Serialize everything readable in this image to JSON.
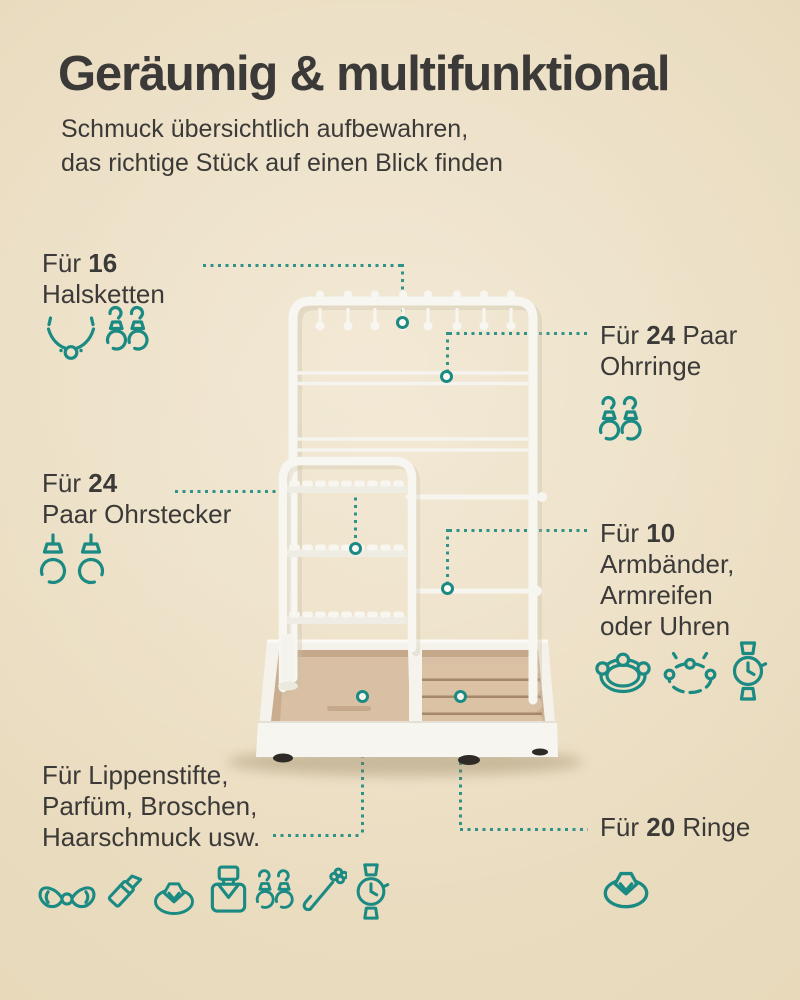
{
  "colors": {
    "accent": "#1a8a82",
    "text": "#3b3a38",
    "bg": "#e8dabc",
    "product_white": "#f8f6f1",
    "velvet": "#d9bfa3"
  },
  "header": {
    "title": "Geräumig & multifunktional",
    "subtitle1": "Schmuck übersichtlich aufbewahren,",
    "subtitle2": "das richtige Stück auf einen Blick finden"
  },
  "callouts": {
    "necklaces": {
      "pre": "Für ",
      "num": "16",
      "post": "",
      "line2": "Halsketten",
      "icons": [
        "necklace-icon",
        "earrings-pair-icon"
      ]
    },
    "earrings": {
      "pre": "Für ",
      "num": "24",
      "post": " Paar",
      "line2": "Ohrringe",
      "icons": [
        "earrings-pair-icon"
      ]
    },
    "studs": {
      "pre": "Für ",
      "num": "24",
      "post": "",
      "line2": "Paar Ohrstecker",
      "icons": [
        "stud-earrings-pair-icon"
      ]
    },
    "bracelets": {
      "pre": "Für ",
      "num": "10",
      "post": "",
      "line2": "Armbänder,",
      "line3": "Armreifen",
      "line4": "oder Uhren",
      "icons": [
        "bracelet-icon",
        "bangle-icon",
        "watch-icon"
      ]
    },
    "accessories": {
      "line1": "Für Lippenstifte,",
      "line2": "Parfüm, Broschen,",
      "line3": "Haarschmuck usw.",
      "icons": [
        "bow-icon",
        "lipstick-icon",
        "ring-icon",
        "perfume-icon",
        "earrings-pair-icon",
        "hairpin-icon",
        "watch-icon"
      ]
    },
    "rings": {
      "pre": "Für ",
      "num": "20",
      "post": " Ringe",
      "icons": [
        "ring-icon"
      ]
    }
  },
  "product": {
    "type": "jewelry-organizer-stand",
    "visible_hooks": 8,
    "earring_bar_pairs": 2,
    "bracelet_bars": 2,
    "stud_peg_strips": 3,
    "ring_slot_rows": 4,
    "tray_compartments": 2
  }
}
